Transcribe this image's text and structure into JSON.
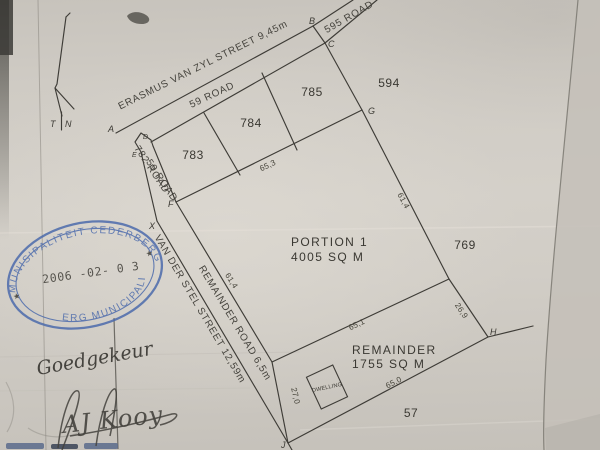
{
  "paper": {
    "background": "#cfcbc4",
    "ink": "#3e3c37"
  },
  "north_arrow": {
    "t": "T",
    "n": "N"
  },
  "streets": {
    "erasmus": "ERASMUS VAN ZYL STREET 9,45m",
    "road_59": "59 ROAD",
    "road_595": "595 ROAD",
    "road_782_small": "782 ROAD",
    "road_59_small": "59 ROAD",
    "van_der_stel": "VAN DER STEL STREET 12,59m",
    "remainder_road": "REMAINDER ROAD 6,5m"
  },
  "parcels": {
    "erf_783": "783",
    "erf_784": "784",
    "erf_785": "785",
    "erf_594": "594",
    "erf_769": "769",
    "erf_57": "57",
    "portion1_line1": "PORTION 1",
    "portion1_line2": "4005 SQ M",
    "remainder_line1": "REMAINDER",
    "remainder_line2": "1755 SQ M",
    "dwelling": "DWELLING"
  },
  "measurements": {
    "fg": "65,3",
    "gh_upper": "61,4",
    "h_lower": "26,9",
    "wh": "65,1",
    "jh": "65,0",
    "wj": "27,0",
    "fw": "61,4"
  },
  "beacons": {
    "a": "A",
    "b": "B",
    "c": "C",
    "d": "D",
    "e": "E",
    "f": "F",
    "g": "G",
    "h": "H",
    "j": "J",
    "x": "X"
  },
  "stamp": {
    "top_arc": "MUNISIPALITEIT CEDERBERG",
    "bottom_arc": "ERG MUNICIPALITY",
    "date": "2006 -02- 0 3",
    "star_left": "★",
    "star_right": "★",
    "color": "#4767ab"
  },
  "handwriting": {
    "approved": "Goedgekeur",
    "signature": "AJ Kooy"
  }
}
